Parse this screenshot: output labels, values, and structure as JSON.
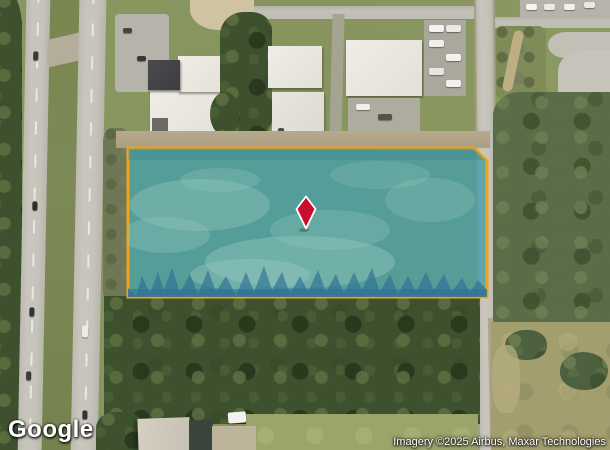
{
  "map": {
    "provider_logo": "Google",
    "attribution": "Imagery ©2025 Airbus, Maxar Technologies",
    "view_type": "satellite",
    "parcel": {
      "outline_color": "#f0a41c",
      "fill_color": "#4a9fa5",
      "fill_opacity": "0.82"
    },
    "marker": {
      "shape": "diamond",
      "fill_color": "#c8102e",
      "outline_color": "#ffffff"
    }
  }
}
